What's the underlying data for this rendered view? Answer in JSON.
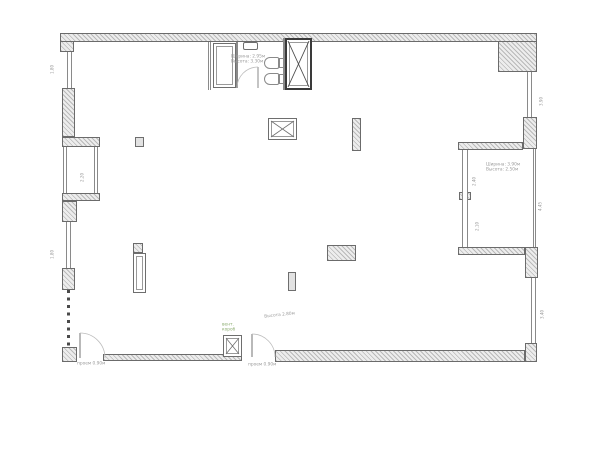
{
  "drawing": {
    "kind": "apartment floor plan",
    "background": "#ffffff"
  },
  "colors": {
    "wall_border": "#6b6b6b",
    "wall_fill": "#ededed",
    "hatch_line": "#b9b9b9",
    "thin_line": "#8a8a8a",
    "dark_border": "#3a3a3a",
    "dim_text": "#9b9b9b",
    "green_note": "#8aab6e"
  },
  "annotations": {
    "bathroom_line1": "Ширина: 2.95м",
    "bathroom_line2": "Высота: 3.30м",
    "loggia_line1": "Ширина: 3.90м",
    "loggia_line2": "Высота: 2.50м",
    "mid_door_note": "Высота 2.80м",
    "left_door_dim": "проем 0.90м",
    "mid_door_dim": "проем 0.90м",
    "duct_line1": "вент.",
    "duct_line2": "короб"
  },
  "dims": {
    "left_top": "1.80",
    "left_mid": "1.80",
    "bay": "2.20",
    "right_top": "3.90",
    "right_mid": "4.45",
    "right_bottom": "3.40",
    "loggia_a": "2.40",
    "loggia_b": "2.10"
  }
}
